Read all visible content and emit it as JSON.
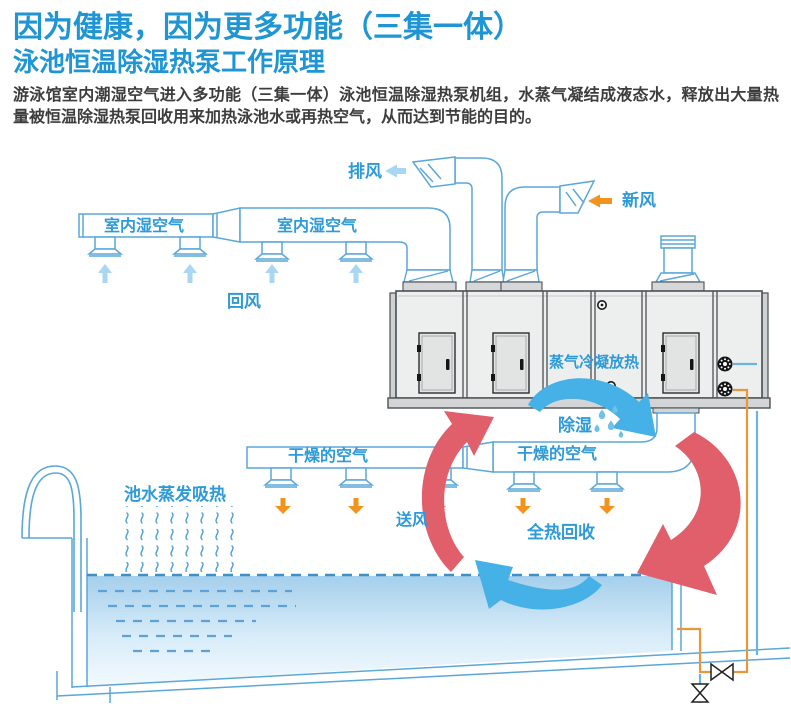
{
  "header": {
    "title_line1": "因为健康，因为更多功能（三集一体）",
    "title_line2": "泳池恒温除湿热泵工作原理",
    "description": "游泳馆室内潮湿空气进入多功能（三集一体）泳池恒温除湿热泵机组，水蒸气凝结成液态水，释放出大量热量被恒温除湿热泵回收用来加热泳池水或再热空气，从而达到节能的目的。"
  },
  "diagram": {
    "labels": {
      "exhaust_air": "排风",
      "fresh_air": "新风",
      "indoor_humid_air_1": "室内湿空气",
      "indoor_humid_air_2": "室内湿空气",
      "return_air": "回风",
      "steam_condensation": "蒸气冷凝放热",
      "dehumidify": "除湿",
      "dry_air_1": "干燥的空气",
      "dry_air_2": "干燥的空气",
      "supply_air": "送风",
      "total_heat_recovery": "全热回收",
      "pool_evaporation": "池水蒸发吸热"
    },
    "colors": {
      "title_blue": "#2095d3",
      "label_blue": "#2e9ad8",
      "duct_blue": "#5aa7d8",
      "arrow_red": "#e05f6b",
      "arrow_blue": "#45b1e6",
      "arrow_orange": "#f0931f",
      "arrow_lightblue": "#a9d6f2",
      "pipe_orange": "#e8973a",
      "pipe_blue": "#6ab4e0",
      "unit_gray": "#edefef",
      "unit_border": "#4b5054",
      "water_top": "#a5cfeb",
      "water_bottom": "#f2f9fe"
    }
  }
}
